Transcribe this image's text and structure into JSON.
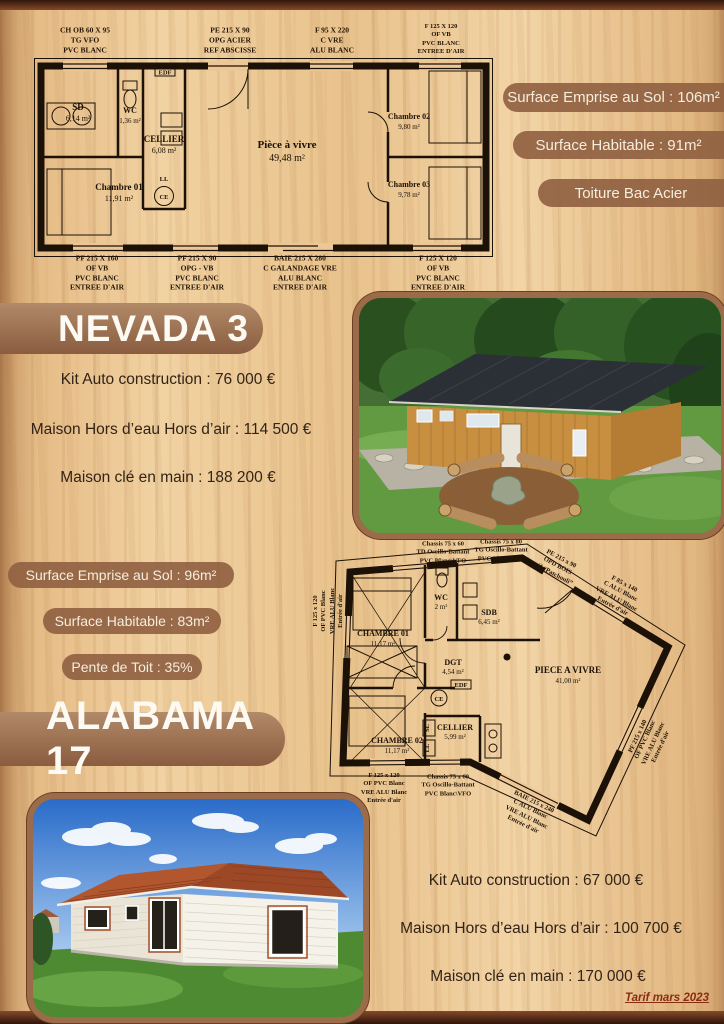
{
  "footer": {
    "tarif_note": "Tarif mars 2023"
  },
  "colors": {
    "wood": "#ecc795",
    "accent_brown": "#8f5f40",
    "edge_bar": "#5a2d1a",
    "price_text": "#322317",
    "badge_text": "#f6eedd"
  },
  "nevada": {
    "title": "NEVADA 3",
    "badges": [
      "Surface Emprise au Sol : 106m²",
      "Surface Habitable : 91m²",
      "Toiture Bac Acier"
    ],
    "prices": [
      "Kit Auto construction : 76 000 €",
      "Maison Hors d’eau Hors d’air : 114 500 €",
      "Maison clé en main : 188 200 €"
    ],
    "plan": {
      "top_labels": [
        [
          "CH OB 60 X 95",
          "TG VFO",
          "PVC BLANC"
        ],
        [
          "PE 215 X 90",
          "OPG ACIER",
          "REF ABSCISSE"
        ],
        [
          "F 95 X 220",
          "C VRE",
          "ALU BLANC"
        ],
        [
          "F 125 X 120",
          "OF VB",
          "PVC BLANC",
          "ENTREE D'AIR"
        ]
      ],
      "bottom_labels": [
        [
          "PF 215 X 160",
          "OF VB",
          "PVC BLANC",
          "ENTREE D'AIR"
        ],
        [
          "PF 215 X 90",
          "OPG - VB",
          "PVC BLANC",
          "ENTREE D'AIR"
        ],
        [
          "BAIE 215 X 280",
          "C GALANDAGE VRE",
          "ALU BLANC",
          "ENTREE D'AIR"
        ],
        [
          "F 125 X 120",
          "OF VB",
          "PVC BLANC",
          "ENTREE D'AIR"
        ]
      ],
      "rooms": {
        "sd": {
          "name": "SD",
          "area": "6,14 m²"
        },
        "wc": {
          "name": "WC",
          "area": "1,36 m²"
        },
        "cellier": {
          "name": "CELLIER",
          "area": "6,08 m²"
        },
        "chambre1": {
          "name": "Chambre 01",
          "area": "11,91 m²"
        },
        "sejour": {
          "name": "Pièce à vivre",
          "area": "49,48 m²"
        },
        "chambre2": {
          "name": "Chambre 02",
          "area": "9,80 m²"
        },
        "chambre3": {
          "name": "Chambre 03",
          "area": "9,78 m²"
        }
      },
      "tags": {
        "edf": "EDF",
        "ll": "LL",
        "ce": "CE"
      }
    }
  },
  "alabama": {
    "title": "ALABAMA 17",
    "badges": [
      "Surface Emprise au Sol : 96m²",
      "Surface Habitable : 83m²",
      "Pente de Toit : 35%"
    ],
    "prices": [
      "Kit Auto construction : 67 000 €",
      "Maison Hors d’eau Hors d’air : 100 700 €",
      "Maison clé en main : 170 000 €"
    ],
    "plan": {
      "labels": {
        "chassis_td_top": [
          "Chassis 75 x 60",
          "TD Oscillo-Battant",
          "PVC Blanc\\VFO"
        ],
        "chassis_tg_top": [
          "Chassis 75 x 80",
          "TG Oscillo-Battant",
          "PVC Blanc\\VFO"
        ],
        "pe_bois": [
          "PE 215 x 90",
          "OPD BOIS",
          "réf “Patchouli”"
        ],
        "f85": [
          "F 85 x 140",
          "C ALU Blanc",
          "VRE ALU Blanc",
          "Entrée d'air"
        ],
        "pf215": [
          "PF 215 x 140",
          "OF PVC Blanc",
          "VRE ALU Blanc",
          "Entrée d'air"
        ],
        "f125_left": [
          "F 125 x 120",
          "OF PVC Blanc",
          "VRE ALU Blanc",
          "Entrée d'air"
        ],
        "f125_bottom": [
          "F 125 x 120",
          "OF PVC Blanc",
          "VRE ALU Blanc",
          "Entrée d'air"
        ],
        "chassis_tg_bottom": [
          "Chassis 75 x 60",
          "TG Oscillo-Battant",
          "PVC Blanc\\VFO"
        ],
        "baie": [
          "BAIE 215 x 240",
          "C ALU Blanc",
          "VRE ALU Blanc",
          "Entrée d'air"
        ]
      },
      "rooms": {
        "chambre1": {
          "name": "CHAMBRE 01",
          "area": "11,17 m²"
        },
        "wc": {
          "name": "WC",
          "area": "2 m²"
        },
        "sdb": {
          "name": "SDB",
          "area": "6,45 m²"
        },
        "dgt": {
          "name": "DGT",
          "area": "4,54 m²"
        },
        "sejour": {
          "name": "PIECE A VIVRE",
          "area": "41,00 m²"
        },
        "cellier": {
          "name": "CELLIER",
          "area": "5,99 m²"
        },
        "chambre2": {
          "name": "CHAMBRE 02",
          "area": "11,17 m²"
        }
      },
      "tags": {
        "ce": "CE",
        "sl": "SL",
        "ll": "LL",
        "edf": "EDF"
      }
    }
  }
}
